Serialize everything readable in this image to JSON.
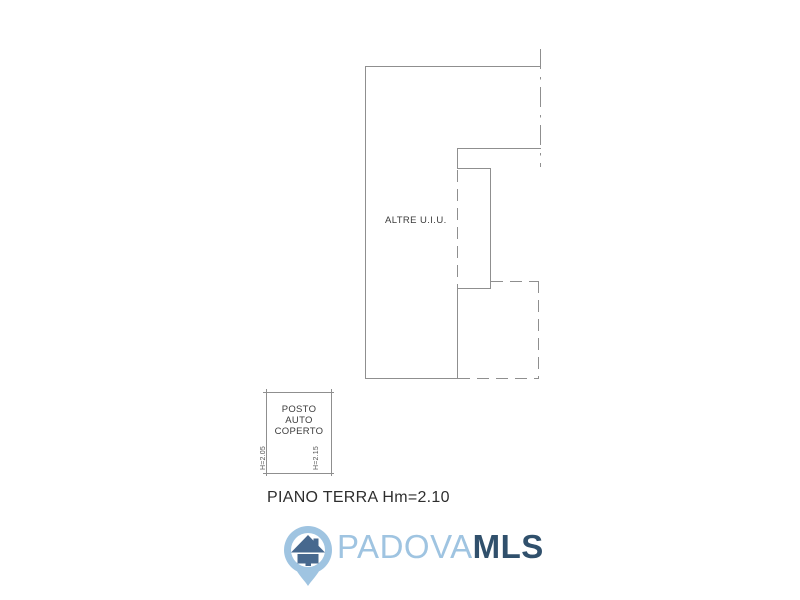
{
  "page": {
    "background_color": "#ffffff",
    "type": "real-estate floor plan image"
  },
  "floorplan": {
    "line_color": "#8f8f8f",
    "text_color": "#3b3b3b",
    "room_label": "ALTRE U.I.U.",
    "carport_box": {
      "label_lines": [
        "POSTO",
        "AUTO",
        "COPERTO"
      ],
      "height_left": "H=2.05",
      "height_right": "H=2.15"
    },
    "caption": "PIANO TERRA Hm=2.10"
  },
  "logo": {
    "brand_name_light": "PADOVA",
    "brand_name_bold": "MLS",
    "light_blue": "#9fc4e1",
    "dark_blue": "#30506c",
    "house_blue": "#47688e"
  }
}
